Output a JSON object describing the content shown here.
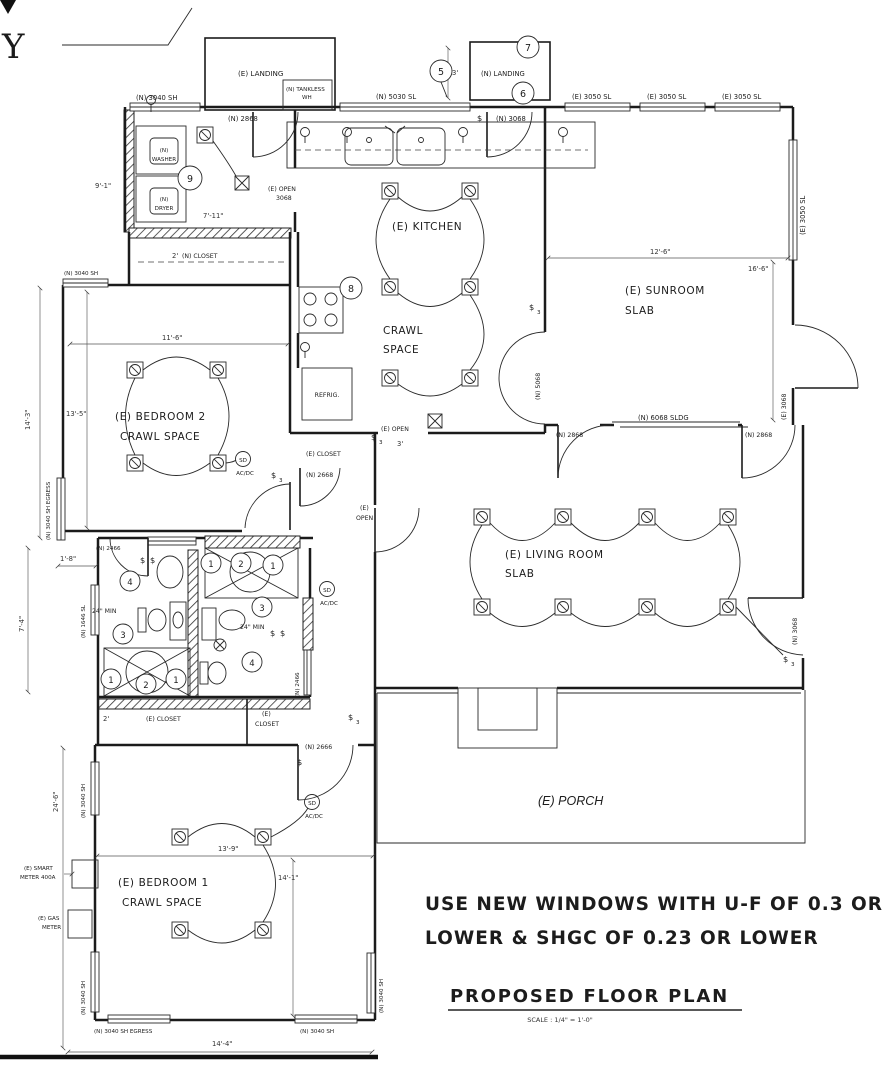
{
  "corner": {
    "partial_letter": "Y"
  },
  "notes": {
    "line1": "USE NEW WINDOWS WITH U-F OF 0.3 OR",
    "line2": "LOWER & SHGC OF 0.23 OR LOWER"
  },
  "title_block": {
    "title": "PROPOSED FLOOR PLAN",
    "scale": "SCALE : 1/4\" = 1'-0\""
  },
  "rooms": {
    "landing_e": "(E) LANDING",
    "landing_n": "(N) LANDING",
    "tankless_1": "(N) TANKLESS",
    "tankless_2": "WH",
    "kitchen": "(E) KITCHEN",
    "crawl_1": "CRAWL",
    "crawl_2": "SPACE",
    "sunroom_1": "(E) SUNROOM",
    "sunroom_2": "SLAB",
    "bedroom2_1": "(E) BEDROOM 2",
    "bedroom2_2": "CRAWL SPACE",
    "living_1": "(E) LIVING ROOM",
    "living_2": "SLAB",
    "bedroom1_1": "(E) BEDROOM 1",
    "bedroom1_2": "CRAWL SPACE",
    "porch": "(E) PORCH",
    "closet_new": "(N) CLOSET",
    "closet_hall": "(E) CLOSET",
    "closet_bed1_a": "(E) CLOSET",
    "closet_bed1_b_1": "(E)",
    "closet_bed1_b_2": "CLOSET",
    "open_laundry_1": "(E) OPEN",
    "open_laundry_2": "3068",
    "open_hall_1": "(E)",
    "open_hall_2": "OPEN",
    "open_crawl": "(E) OPEN",
    "refrig": "REFRIG."
  },
  "windows": {
    "n3040sh": "(N) 3040 SH",
    "n5030sl": "(N) 5030 SL",
    "e3050sl": "(E) 3050 SL",
    "n3040sh_egress": "(N) 3040 SH EGRESS",
    "n1646sl": "(N) 1646 SL",
    "n2466": "(N) 2466"
  },
  "doors": {
    "n2868": "(N) 2868",
    "n3068": "(N) 3068",
    "e3068": "(E) 3068",
    "n6068sldg": "(N) 6068 SLDG",
    "n5068": "(N) 5068",
    "n2666": "(N) 2666",
    "n2668": "(N) 2668"
  },
  "dims": {
    "d9_1": "9'-1\"",
    "d7_11": "7'-11\"",
    "d2": "2'",
    "d3": "3'",
    "d12_6": "12'-6\"",
    "d16_6": "16'-6\"",
    "d11_6": "11'-6\"",
    "d13_5": "13'-5\"",
    "d14_3": "14'-3\"",
    "d1_8": "1'-8\"",
    "d7_4": "7'-4\"",
    "d24min": "24\" MIN",
    "d24_6": "24'-6\"",
    "d13_9": "13'-9\"",
    "d14_1": "14'-1\"",
    "d14_4": "14'-4\""
  },
  "equipment": {
    "washer_1": "(N)",
    "washer_2": "WASHER",
    "dryer_1": "(N)",
    "dryer_2": "DRYER",
    "smart_meter_1": "(E) SMART",
    "smart_meter_2": "METER 400A",
    "gas_meter_1": "(E) GAS",
    "gas_meter_2": "METER",
    "sd": "SD",
    "acdc": "AC/DC",
    "switch": "$",
    "switch3_sub": "3"
  },
  "keynotes": {
    "k1": "1",
    "k2": "2",
    "k3": "3",
    "k4": "4",
    "k5": "5",
    "k6": "6",
    "k7": "7",
    "k8": "8",
    "k9": "9"
  }
}
